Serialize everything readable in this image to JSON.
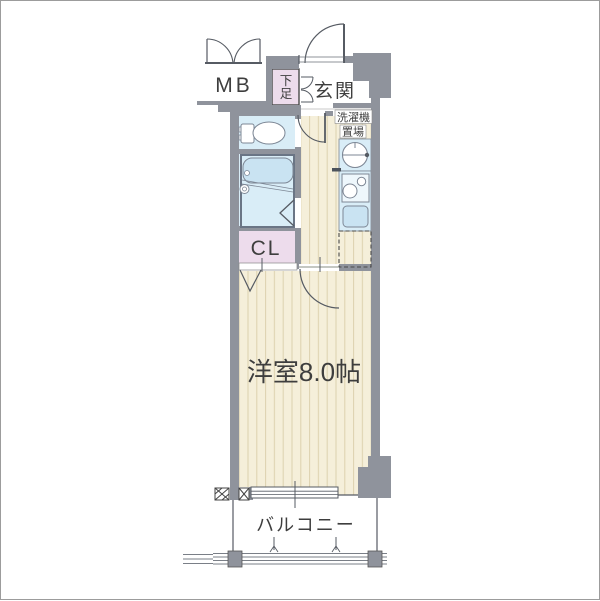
{
  "page": {
    "type": "japanese-apartment-floor-plan"
  },
  "colors": {
    "background": "#ffffff",
    "wall": "#8f939c",
    "wall_line": "#565b63",
    "fixture_room_blue": "#d9edf7",
    "fixture_fill_blue": "#c9e3f2",
    "closet_pink": "#eddcec",
    "floor_cream": "#f5efda",
    "floor_stripe": "#dcd1ae",
    "text": "#3e3e3e",
    "frame": "#9c9c9c"
  },
  "labels": {
    "meter_box": "MB",
    "shoe_cabinet_chars": [
      "下",
      "足"
    ],
    "entrance": "玄関",
    "washer_area_lines": [
      "洗濯機",
      "置場"
    ],
    "closet": "CL",
    "main_room": "洋室8.0帖",
    "balcony": "バルコニー"
  }
}
